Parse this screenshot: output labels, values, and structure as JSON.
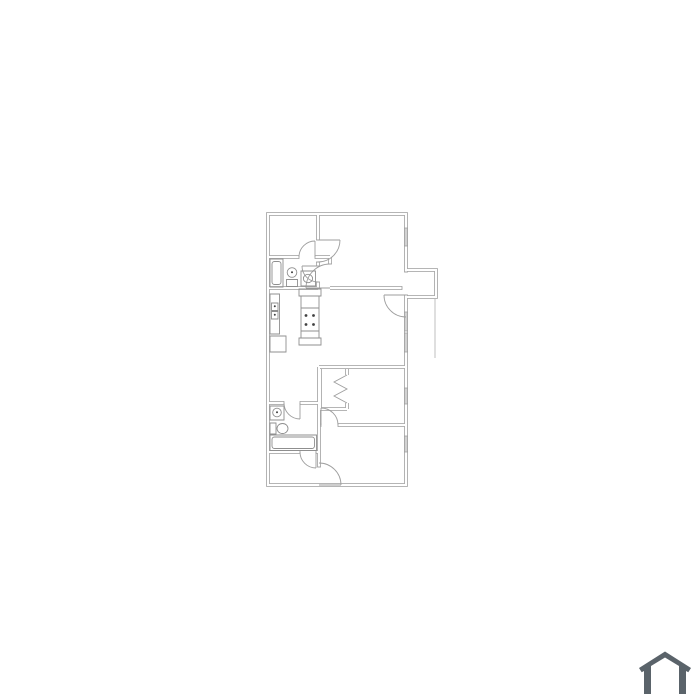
{
  "page": {
    "background": "#ffffff"
  },
  "floorplan": {
    "colors": {
      "wall": "#ababab",
      "wall_fill": "#ffffff",
      "jamb": "#a3a3a3",
      "door": "#9e9e9e",
      "fixture": "#8f8f8f",
      "window_fill": "#d2d2d2",
      "window_stroke": "#9e9e9e",
      "dot": "#404040",
      "patio": "#b8b8b8"
    },
    "paths": {
      "walls": "M406 272 V214 H268 V485 H406 V295 M268 257 H299 M315 257 H330 M318 214 V240 M318 262 V266 M318 282 V288 M268 288 H318 M330 257 V264 M330 288 H402 M319 367 H406 M319 367 V467 M338 425 H406 M268 403 H284 M300 403 H319 M268 452 H300 M316 452 H319 M320 369 V409 M320 409 H347 M347 369 V375 M347 403 V409 M406 270 H436 V297 H406",
      "jambs": "M299 255.1 V258.9 M315 255.1 V258.9 M316.1 240 H319.9 M316.1 262 H319.9 M316.1 266 H319.9 M316.1 282 H319.9 M328.1 264 H331.9 M404.1 272 H407.9 M404.1 295 H407.9 M402 286.1 V289.9 M284 401.1 V404.9 M300 401.1 V404.9 M300 450.1 V453.9 M316 450.1 V453.9 M317.1 467 H320.9 M321 423.1 V426.9 M338 423.1 V426.9",
      "doors": "M315 257 V241 M299 257 A16 16 0 0 1 315 241 M318 266 H302 M302 266 A16 16 0 0 0 318 282 M330 288 H306 M306 288 A24 24 0 0 1 330 264 M318 240 H340 M340 240 A22 22 0 0 1 318 262 M406 295 H384 M384 295 A22 22 0 0 0 406 317 M321 425 V408 M321 408 A17 17 0 0 1 338 425 M319 485 H341 M341 485 A22 22 0 0 0 319 463 M300 403 V419 M284 403 A16 16 0 0 0 300 419 M316 452 V468 M300 452 A16 16 0 0 0 316 468",
      "bifold": "M347 375 L334 382 L347 389 L334 396 L347 403",
      "windows": "M404.4 228 H407.6 V246 H404.4 Z M404.4 312 H407.6 V331 H404.4 Z M404.4 333 H407.6 V352 H404.4 Z M404.4 388 H407.6 V404 H404.4 Z M404.4 436 H407.6 V452 H404.4 Z",
      "bath1_tub": "M270 259 H283 V287 H270 Z M274.5 261.5 H278.5 A2.5 2.5 0 0 1 281 264 V282 A2.5 2.5 0 0 1 278.5 284.5 H274.5 A2.5 2.5 0 0 1 272 282 V264 A2.5 2.5 0 0 1 274.5 261.5 Z",
      "bath1_toilet": "M287.2 272.5 A4.8 4.8 0 1 0 296.8 272.5 A4.8 4.8 0 1 0 287.2 272.5 Z M286.5 279.5 H297.5 V286.5 H286.5 Z",
      "bath1_sink": "M301 271 H315.5 V286 H301 Z M303.4 278.5 A4.6 4.2 0 1 0 312.6 278.5 A4.6 4.2 0 1 0 303.4 278.5 Z",
      "kitchen_counter": "M270 294 H279.5 V334 H270 Z M271.5 303 H278 V310.5 H271.5 Z M271.5 311.5 H278 V319 H271.5 Z",
      "kitchen_fridge": "M270 336 H286 V352 H270 Z",
      "kitchen_range": "M299 289 H321 V296 H299 Z M301 296 H319 V338 H301 Z M299 338 H321 V345 H299 Z M301 308 H319 M301 331 H319",
      "bath2_sink": "M270 406 H284 V420 H270 Z M272.7 412.5 A4.3 4.3 0 1 0 281.3 412.5 A4.3 4.3 0 1 0 272.7 412.5 Z",
      "bath2_toilet": "M270 423 H276 V434 H270 Z M277 428.5 A5.5 5 0 1 0 288 428.5 A5.5 5 0 1 0 277 428.5 Z",
      "bath2_tub": "M270 435 H316.5 V450.5 H270 Z M274.5 437 H312 A2.5 2.5 0 0 1 314.5 439.5 V446 A2.5 2.5 0 0 1 312 448.5 H274.5 A2.5 2.5 0 0 1 272 446 V439.5 A2.5 2.5 0 0 1 274.5 437 Z",
      "patio_line": "M435 299 V358",
      "burner_dots": "M306 315.5 h0.01 M313.5 315.5 h0.01 M306 324.5 h0.01 M313.5 324.5 h0.01",
      "fixture_dots": "M274.8 306.3 h0.01 M274.8 314.8 h0.01 M292 272.3 h0.01 M277 412.3 h0.01"
    }
  },
  "logo": {
    "name": "house-logo",
    "color": "#5a636a",
    "path": "M644 694 V671 L641.7 672.3 L639 668 L665 651.5 L691 668 L688.3 672.3 L686 671 V694 H679 V666 L665 657.5 L651 666 V694 Z"
  }
}
